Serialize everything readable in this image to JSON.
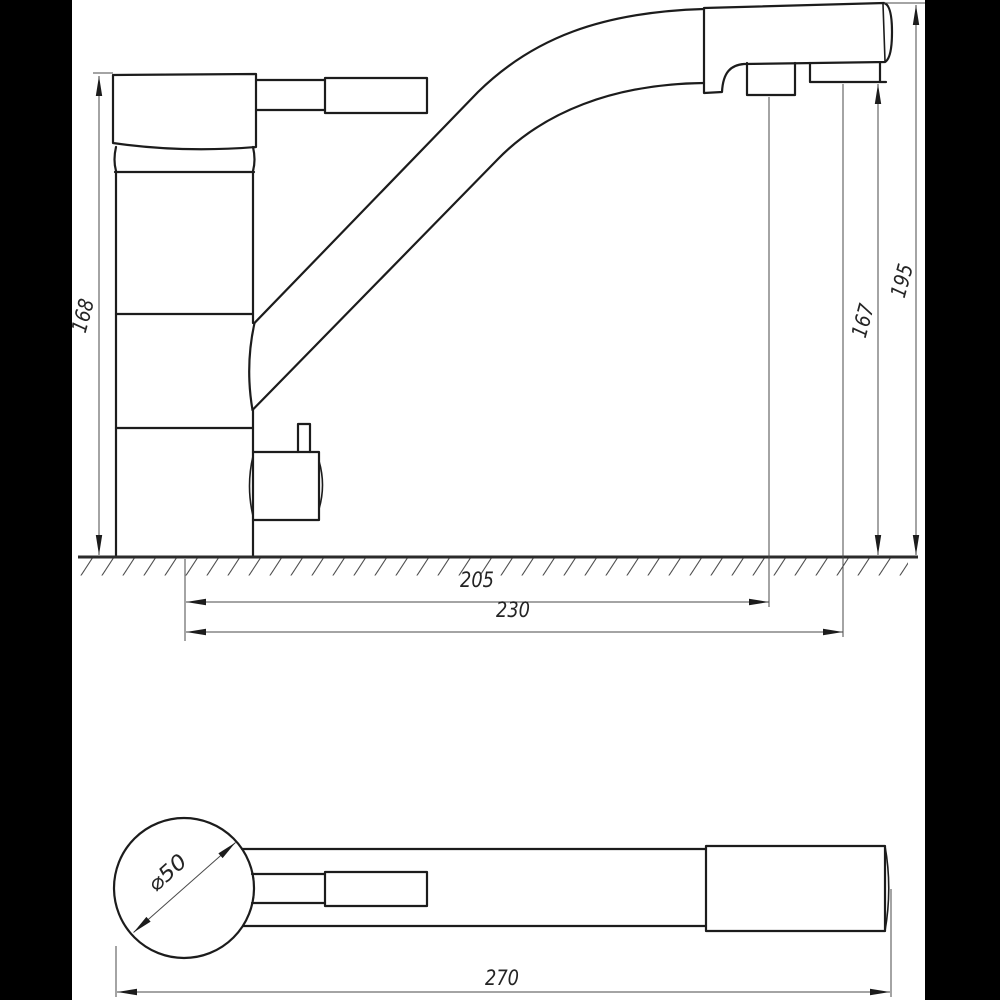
{
  "drawing": {
    "kind": "faucet-dimension-drawing",
    "colors": {
      "line": "#1c1c1c",
      "dim": "#4a4a4a",
      "bg": "#ffffff",
      "letterbox": "#000000"
    },
    "dimensions": {
      "body_height": "168",
      "overall_height": "195",
      "outlet_height": "167",
      "reach_near_outlet": "205",
      "reach_far_outlet": "230",
      "base_diameter": "⌀50",
      "overall_length": "270"
    }
  }
}
